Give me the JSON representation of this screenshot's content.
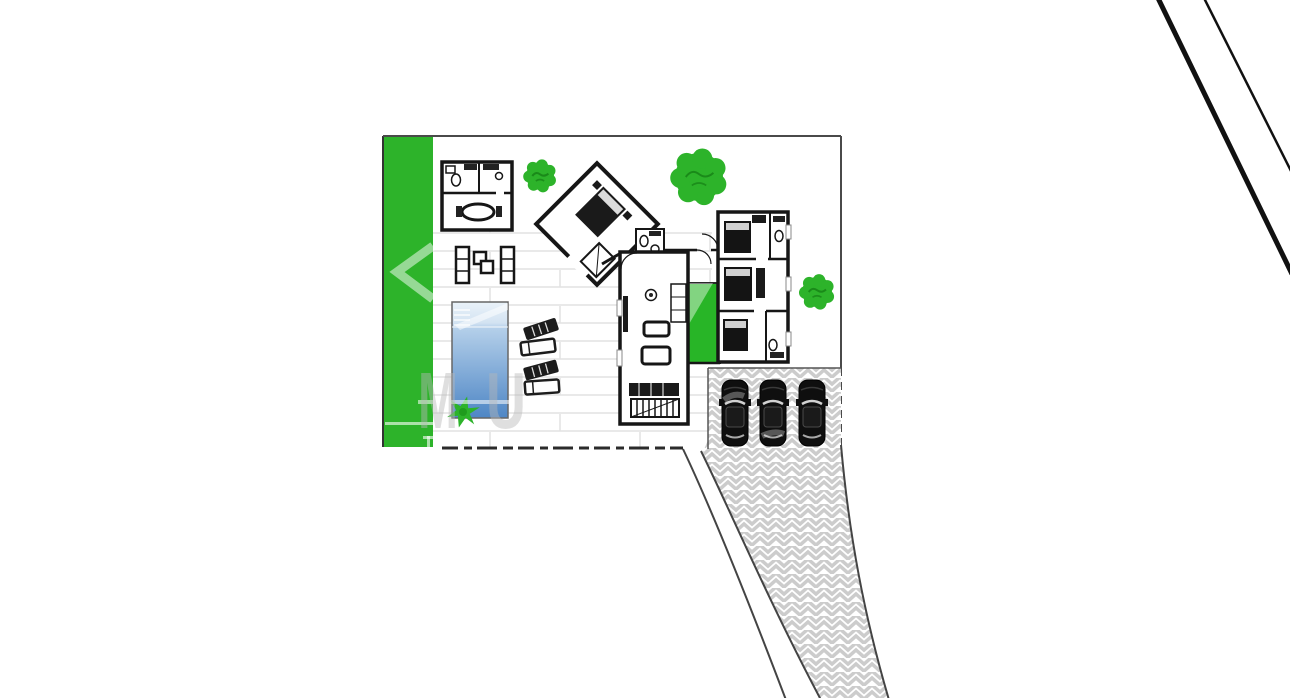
{
  "plan": {
    "type": "architectural-site-plan",
    "buildings": [
      "guest-house",
      "master-suite",
      "bedroom-wing",
      "living-wing"
    ],
    "courtyard_present": true,
    "pool_present": true,
    "parking_spaces": 3
  },
  "colors": {
    "lawn": "#2db32a",
    "tree": "#2db32a",
    "tree_detail": "#157f15",
    "courtyard": "#28b527",
    "pool_top": "#eaf2f9",
    "pool_mid": "#b5d0ea",
    "pool_deep": "#4e86c5",
    "wall": "#161616",
    "hatch": "#cccccc",
    "plank": "#e2e2e2",
    "boundary": "#4a4a4a",
    "road": "#111111",
    "car": "#0f0f0f",
    "watermark_gray": "rgba(185,185,185,0.45)",
    "watermark_white": "rgba(255,255,255,0.5)"
  },
  "watermark": {
    "letters": [
      {
        "char": "M",
        "x": 418
      },
      {
        "char": "U",
        "x": 486
      }
    ],
    "baseline_y": 428,
    "font_size": 80
  },
  "trees": [
    {
      "x": 540,
      "y": 176,
      "r": 14
    },
    {
      "x": 699,
      "y": 177,
      "r": 24
    },
    {
      "x": 817,
      "y": 292,
      "r": 15
    }
  ],
  "cars": [
    {
      "x": 735,
      "y": 380
    },
    {
      "x": 773,
      "y": 380
    },
    {
      "x": 812,
      "y": 380
    }
  ],
  "loungers": [
    {
      "x": 541,
      "y": 329,
      "rot": -18,
      "style": "dark"
    },
    {
      "x": 538,
      "y": 347,
      "rot": -7,
      "style": "outline"
    },
    {
      "x": 541,
      "y": 370,
      "rot": -15,
      "style": "dark"
    },
    {
      "x": 542,
      "y": 387,
      "rot": -4,
      "style": "outline"
    }
  ],
  "road_lines": [
    {
      "x1": 1157,
      "y1": -4,
      "x2": 1292,
      "y2": 274,
      "w": 5
    },
    {
      "x1": 1203,
      "y1": -4,
      "x2": 1292,
      "y2": 173,
      "w": 2.5
    }
  ]
}
